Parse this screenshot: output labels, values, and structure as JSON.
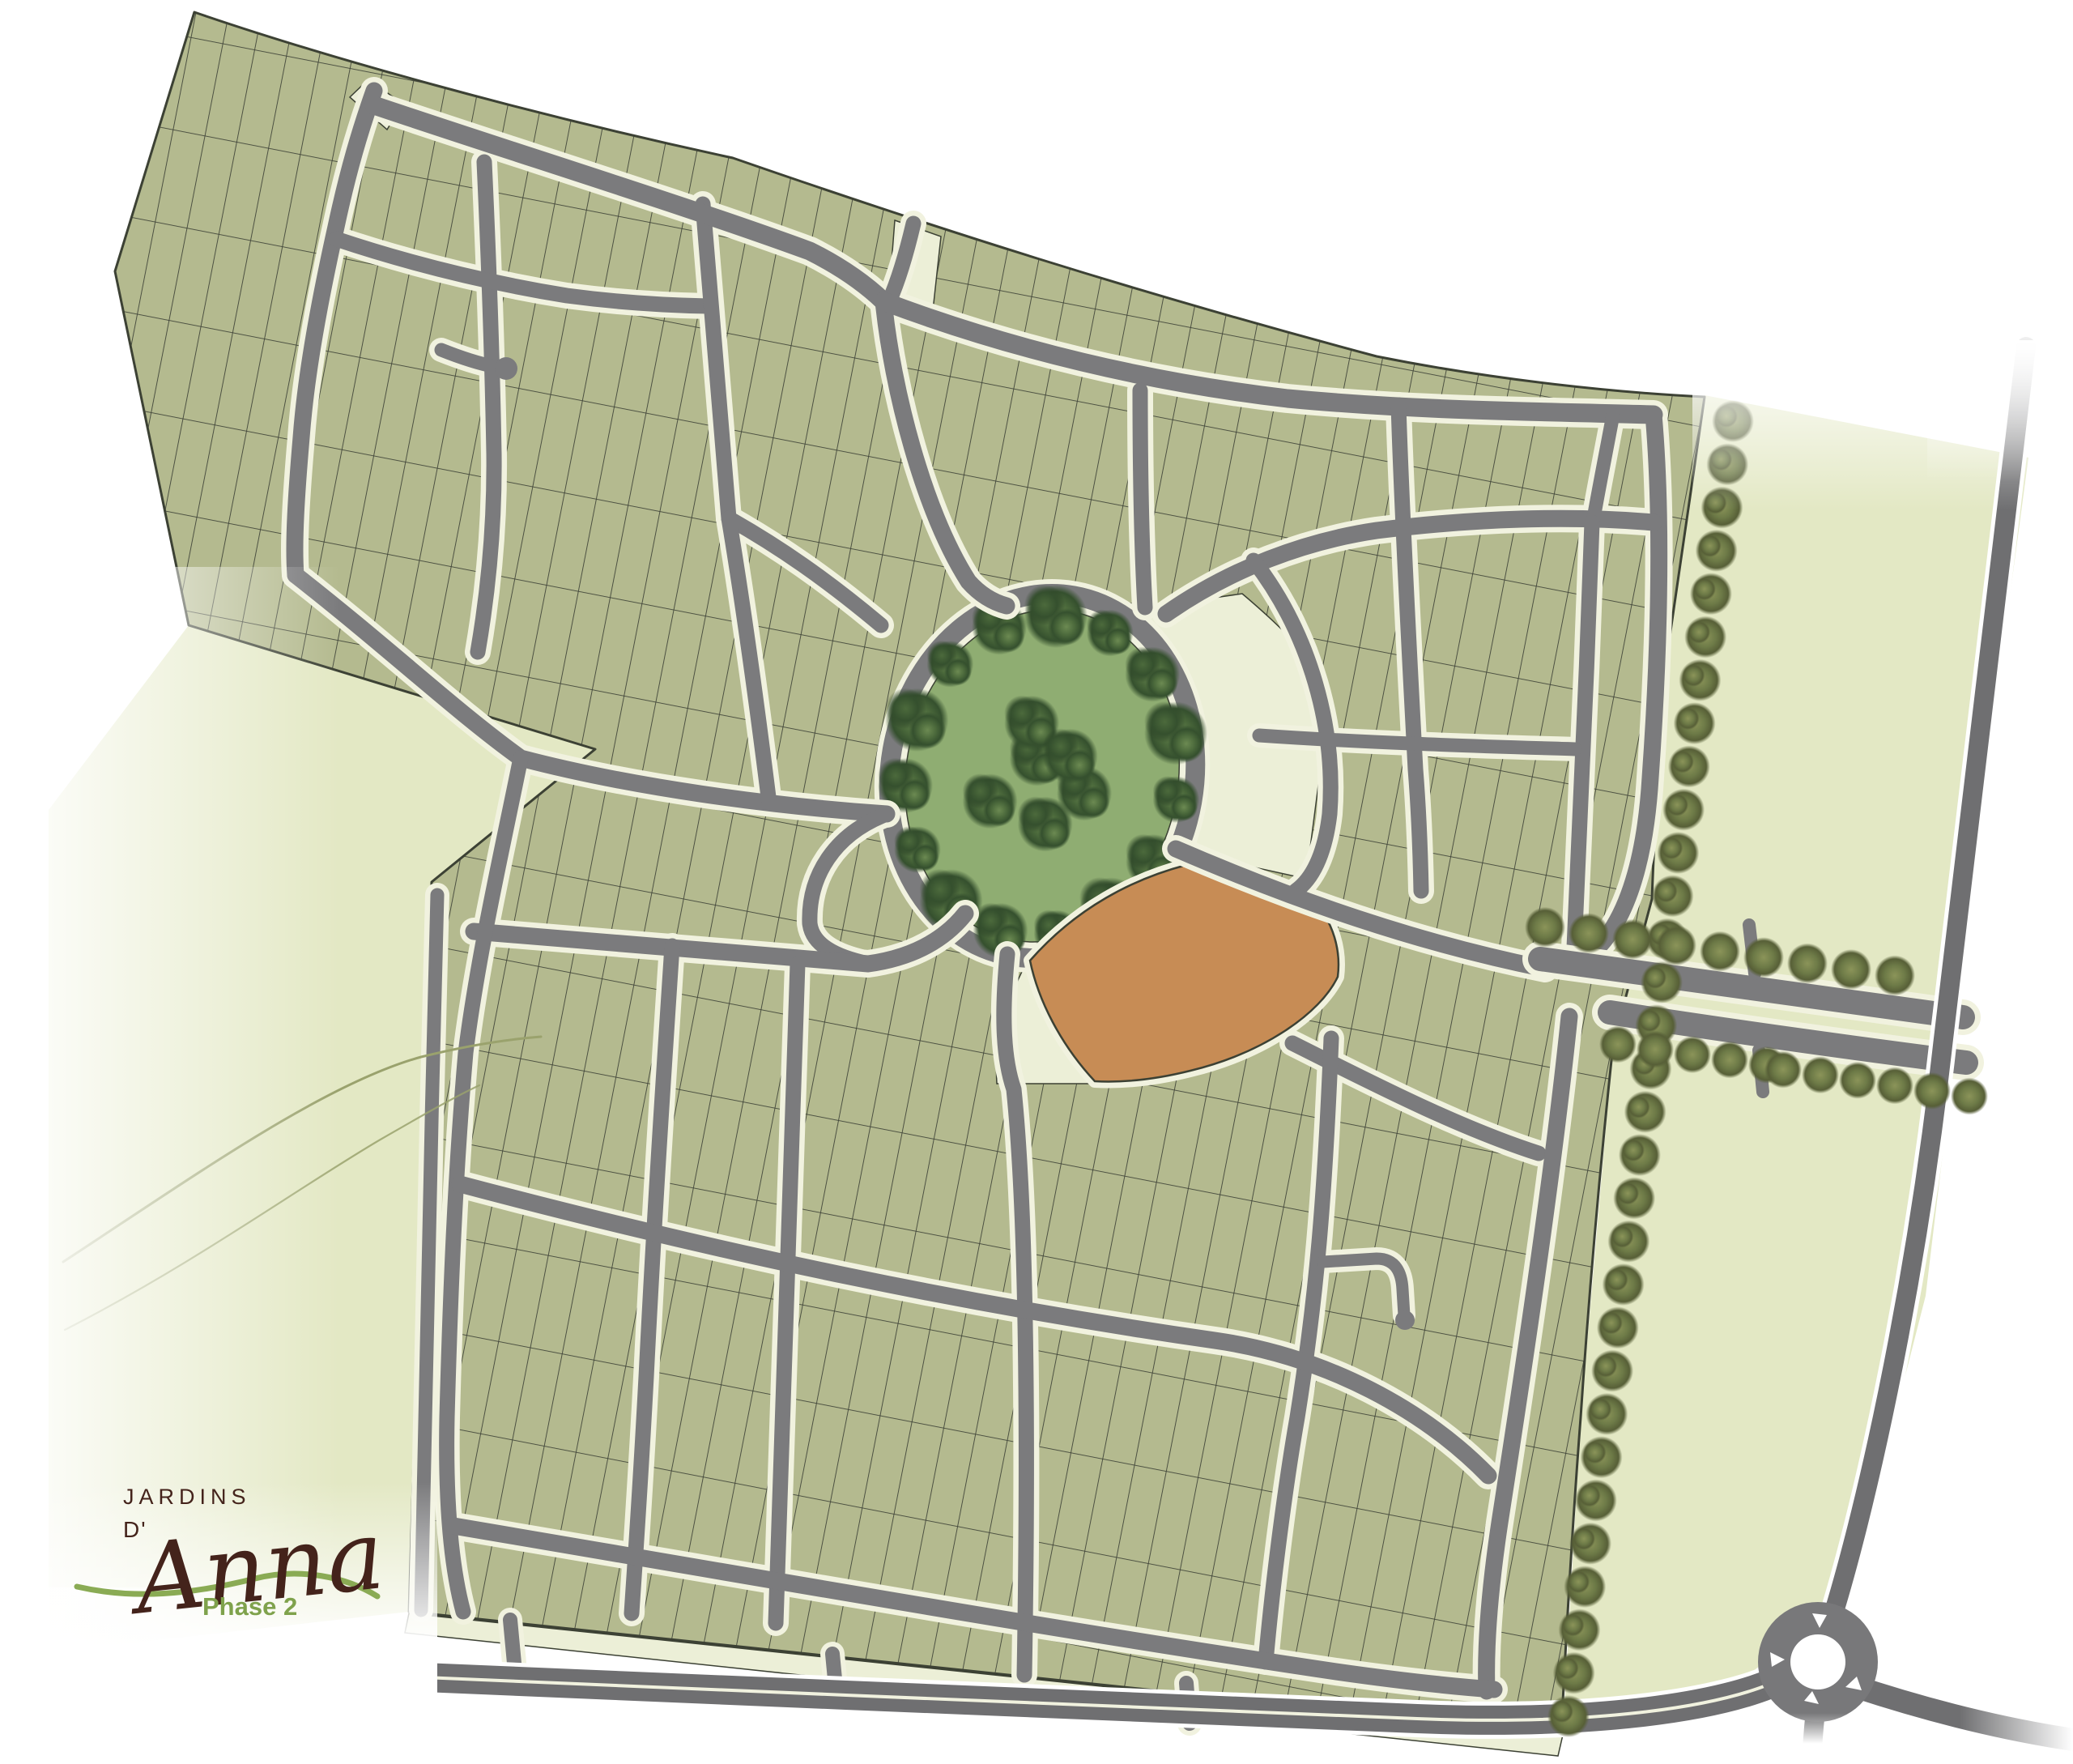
{
  "logo": {
    "brand_top": "JARDINS",
    "brand_mid": "D'",
    "brand_script": "Anna",
    "phase_label": "Phase 2"
  },
  "colors": {
    "bg": "#ffffff",
    "lot_fill": "#b4ba8f",
    "lot_line": "#343930",
    "outline": "#3c4134",
    "pale": "#e3e8c4",
    "pale_sector": "#ecefd7",
    "sidewalk": "#f1f2df",
    "road": "#7b7b7d",
    "road_dark": "#6f6f71",
    "park_grass": "#8fad72",
    "tree_dark": "#35502e",
    "tree_mid": "#4c6a3c",
    "tree_light": "#6c8a52",
    "row_tree": "#6d7a47",
    "orange_parcel": "#c78c55",
    "logo_brown": "#44231b",
    "logo_green": "#8aab54",
    "phase_green": "#7fa24c",
    "stream": "#9aa26d"
  },
  "legend": {
    "central_park": "oval park with perimeter tree ring",
    "orange_parcel": "featured amenity parcel",
    "roundabout": "roundabout at south-east corner",
    "boulevard": "tree-lined entry boulevard (east)",
    "arterial": "boundary arterial road (south)",
    "stream": "stream lines in west open land",
    "street_trees_east_edge": 31,
    "street_trees_boulevard": 20
  }
}
